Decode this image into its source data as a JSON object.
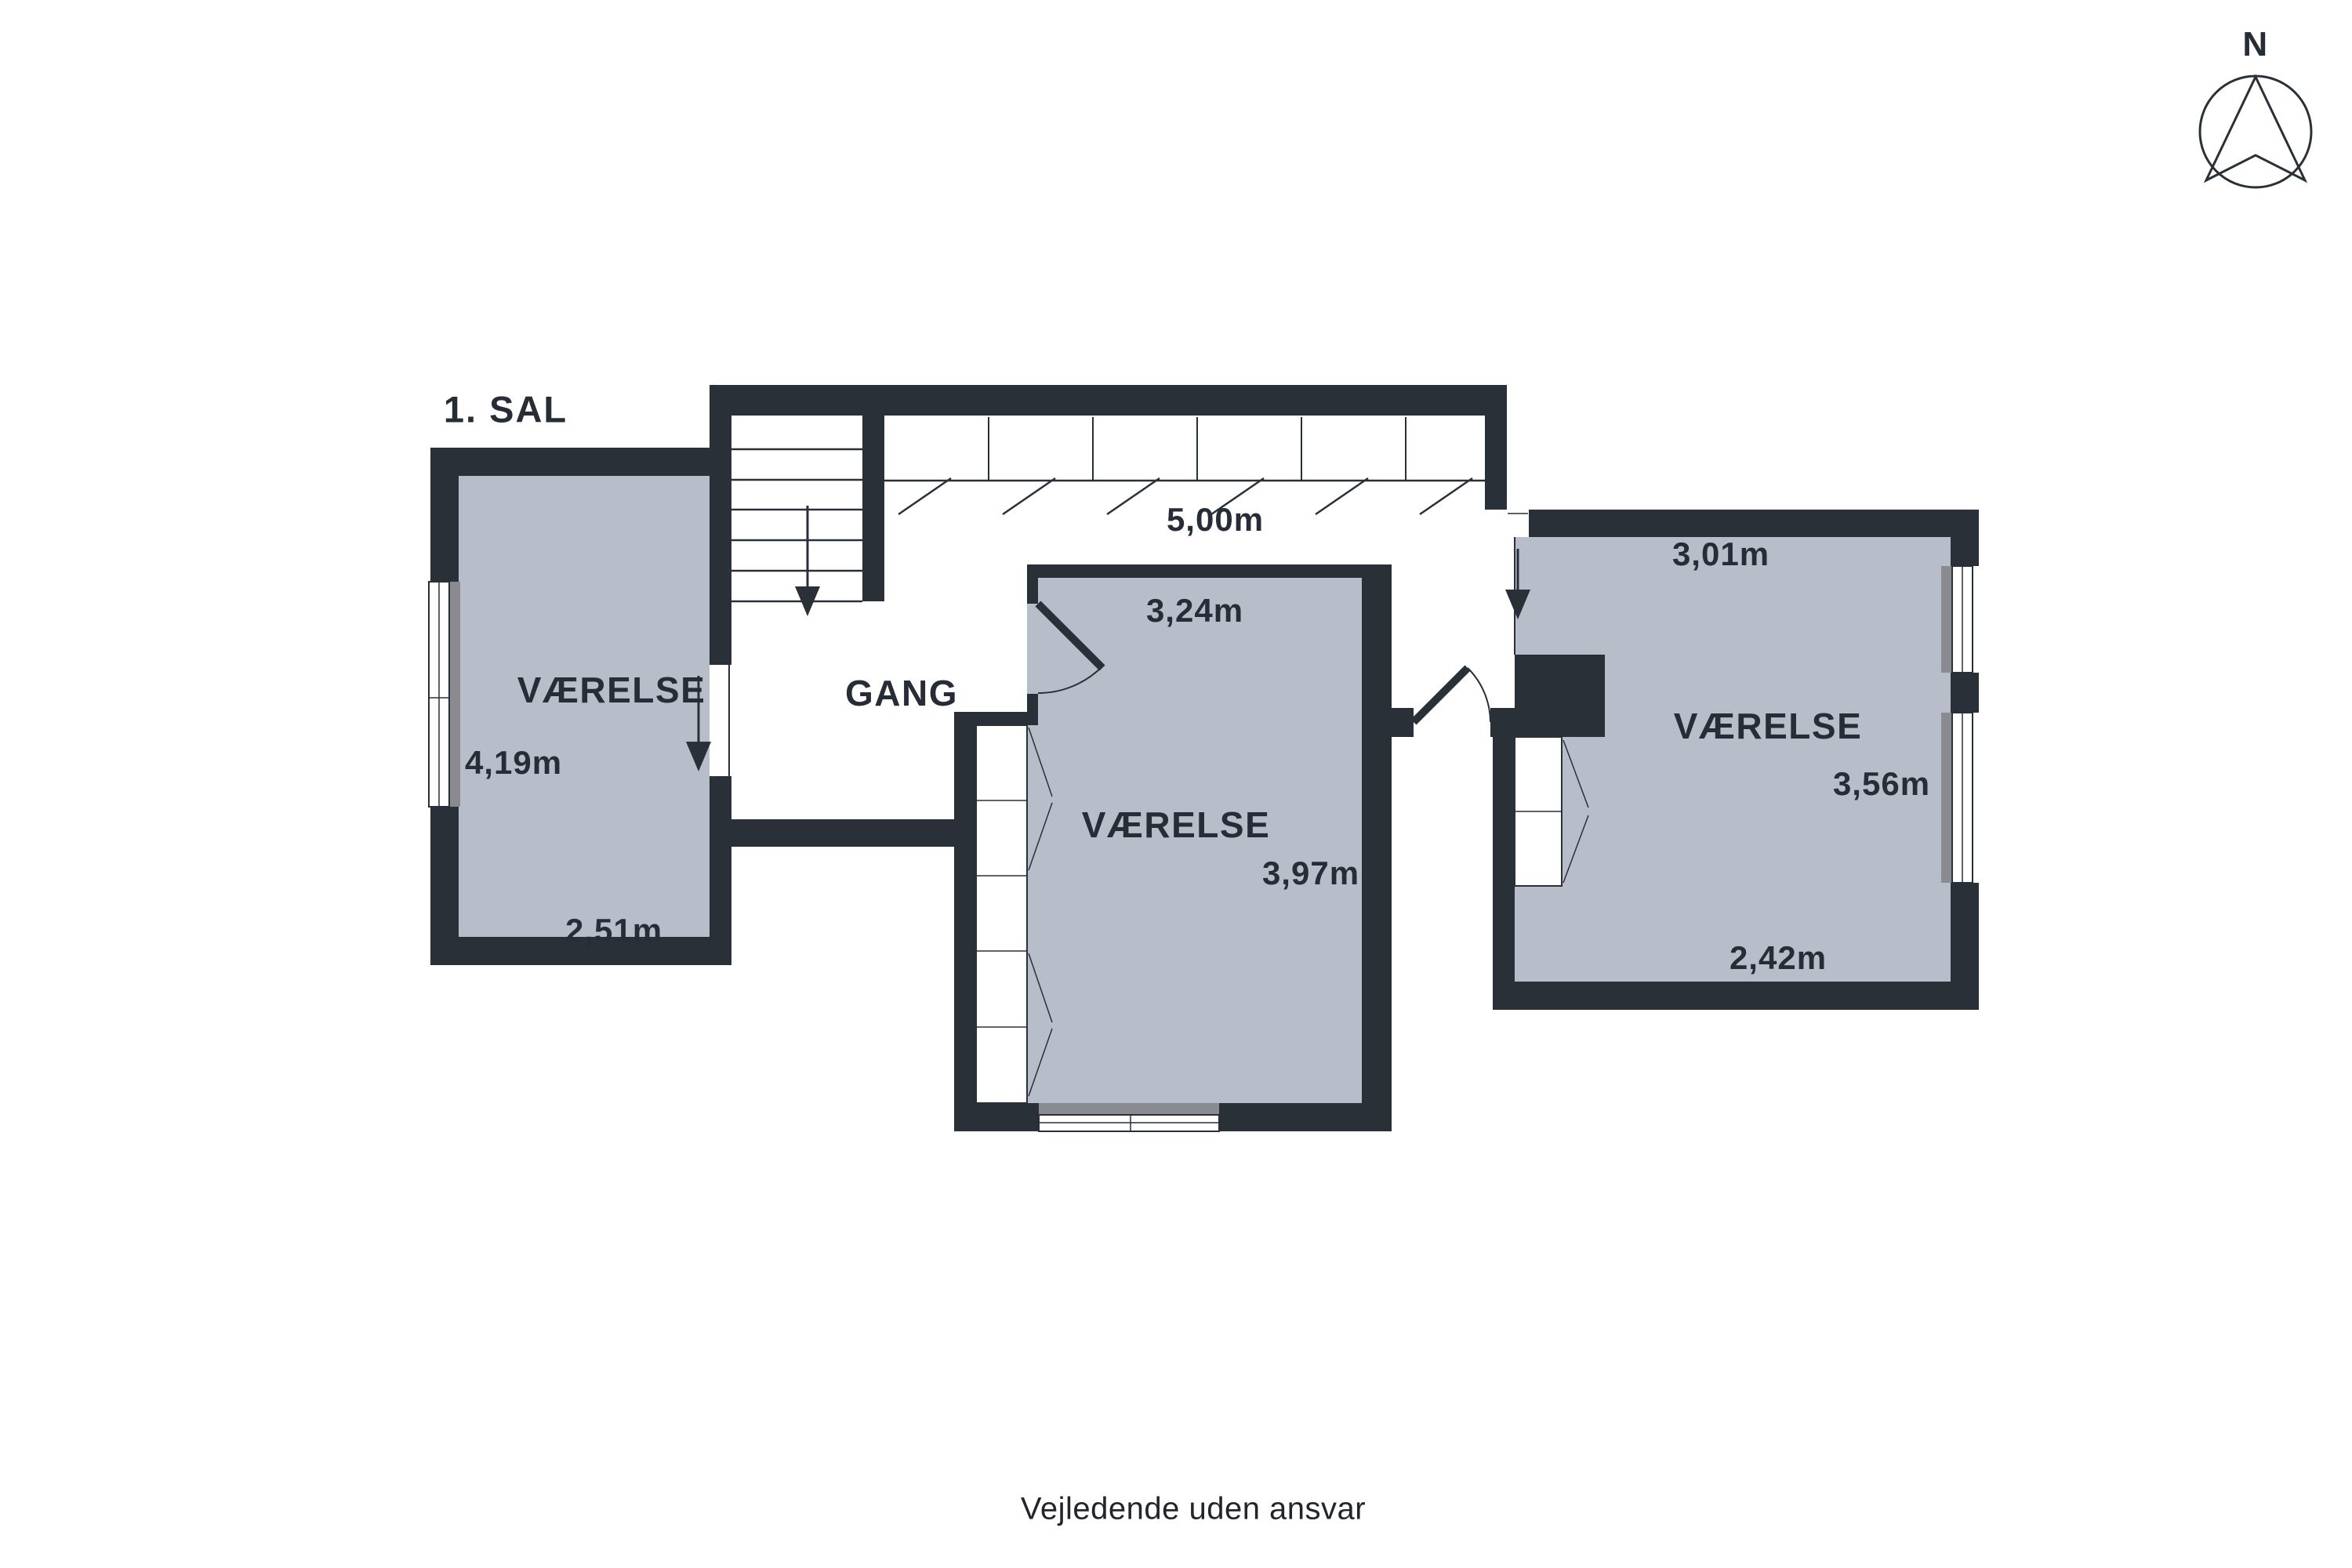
{
  "title": "1. SAL",
  "compass": {
    "label": "N"
  },
  "disclaimer": "Vejledende uden ansvar",
  "colors": {
    "wall": "#2a3038",
    "room_fill": "#b7bec9",
    "window_sill": "#8a8b90",
    "background": "#ffffff",
    "text": "#272d36"
  },
  "hallway": {
    "label": "GANG",
    "corridor_length": "5,00m"
  },
  "rooms": {
    "left": {
      "label": "VÆRELSE",
      "depth": "4,19m",
      "width": "2,51m"
    },
    "middle": {
      "label": "VÆRELSE",
      "width_top": "3,24m",
      "depth": "3,97m"
    },
    "right": {
      "label": "VÆRELSE",
      "width_top": "3,01m",
      "depth": "3,56m",
      "width_bottom": "2,42m"
    }
  }
}
